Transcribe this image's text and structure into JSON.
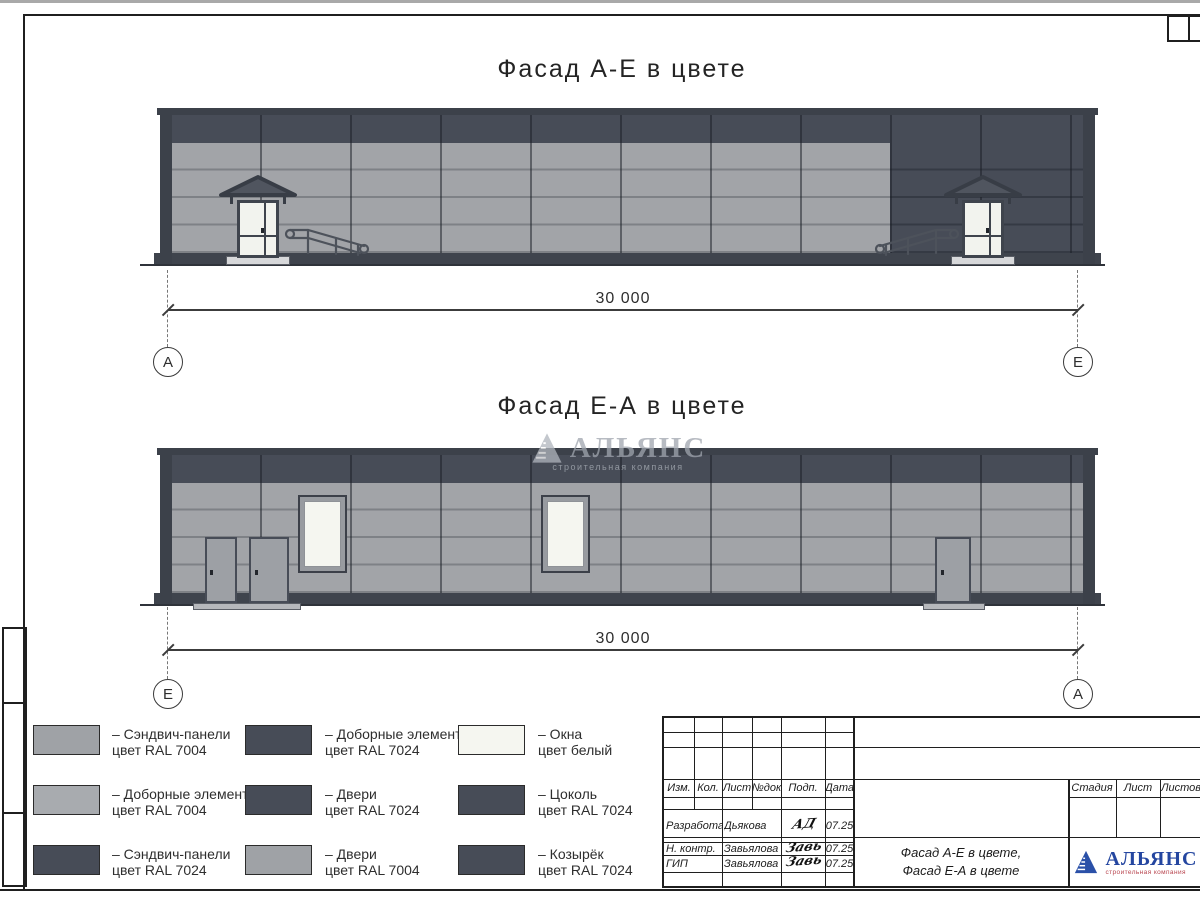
{
  "drawing": {
    "facade_top": {
      "title": "Фасад А-Е в цвете",
      "dimension": "30 000",
      "axis_left": "А",
      "axis_right": "Е"
    },
    "facade_bottom": {
      "title": "Фасад Е-А в цвете",
      "dimension": "30 000",
      "axis_left": "Е",
      "axis_right": "А"
    },
    "watermark": {
      "name": "АЛЬЯНС",
      "subtitle": "строительная компания"
    }
  },
  "legend": {
    "items": [
      {
        "swatch_color": "#9fa2a6",
        "line1": "– Сэндвич-панели",
        "line2": "цвет RAL 7004"
      },
      {
        "swatch_color": "#a8abaf",
        "line1": "– Доборные элементы",
        "line2": "цвет RAL 7004"
      },
      {
        "swatch_color": "#474c57",
        "line1": "– Сэндвич-панели",
        "line2": "цвет RAL 7024"
      },
      {
        "swatch_color": "#474c57",
        "line1": "– Доборные элементы",
        "line2": "цвет RAL 7024"
      },
      {
        "swatch_color": "#474c57",
        "line1": "– Двери",
        "line2": "цвет RAL 7024"
      },
      {
        "swatch_color": "#9fa2a6",
        "line1": "– Двери",
        "line2": "цвет RAL 7004"
      },
      {
        "swatch_color": "#f5f6f0",
        "line1": "– Окна",
        "line2": "цвет белый"
      },
      {
        "swatch_color": "#474c57",
        "line1": "– Цоколь",
        "line2": "цвет RAL 7024"
      },
      {
        "swatch_color": "#474c57",
        "line1": "– Козырёк",
        "line2": "цвет RAL 7024"
      }
    ]
  },
  "title_block": {
    "revision_header": [
      "Изм.",
      "Кол.",
      "Лист",
      "№док",
      "Подп.",
      "Дата"
    ],
    "signature_rows": [
      {
        "role": "Разработал",
        "name": "Дьякова",
        "signature": "АД",
        "date": "07.25"
      },
      {
        "role": "Н. контр.",
        "name": "Завьялова",
        "signature": "Завь",
        "date": "07.25"
      },
      {
        "role": "ГИП",
        "name": "Завьялова",
        "signature": "Завь",
        "date": "07.25"
      }
    ],
    "stage_header": [
      "Стадия",
      "Лист",
      "Листов"
    ],
    "doc_title_line1": "Фасад А-Е в цвете,",
    "doc_title_line2": "Фасад Е-А в цвете",
    "logo": {
      "name": "АЛЬЯНС",
      "subtitle": "строительная компания"
    }
  },
  "colors": {
    "ral_7004": "#9fa2a6",
    "ral_7024": "#474c57",
    "window_white": "#f5f6f0",
    "logo_blue": "#2a50a8",
    "logo_red": "#b8444e"
  }
}
